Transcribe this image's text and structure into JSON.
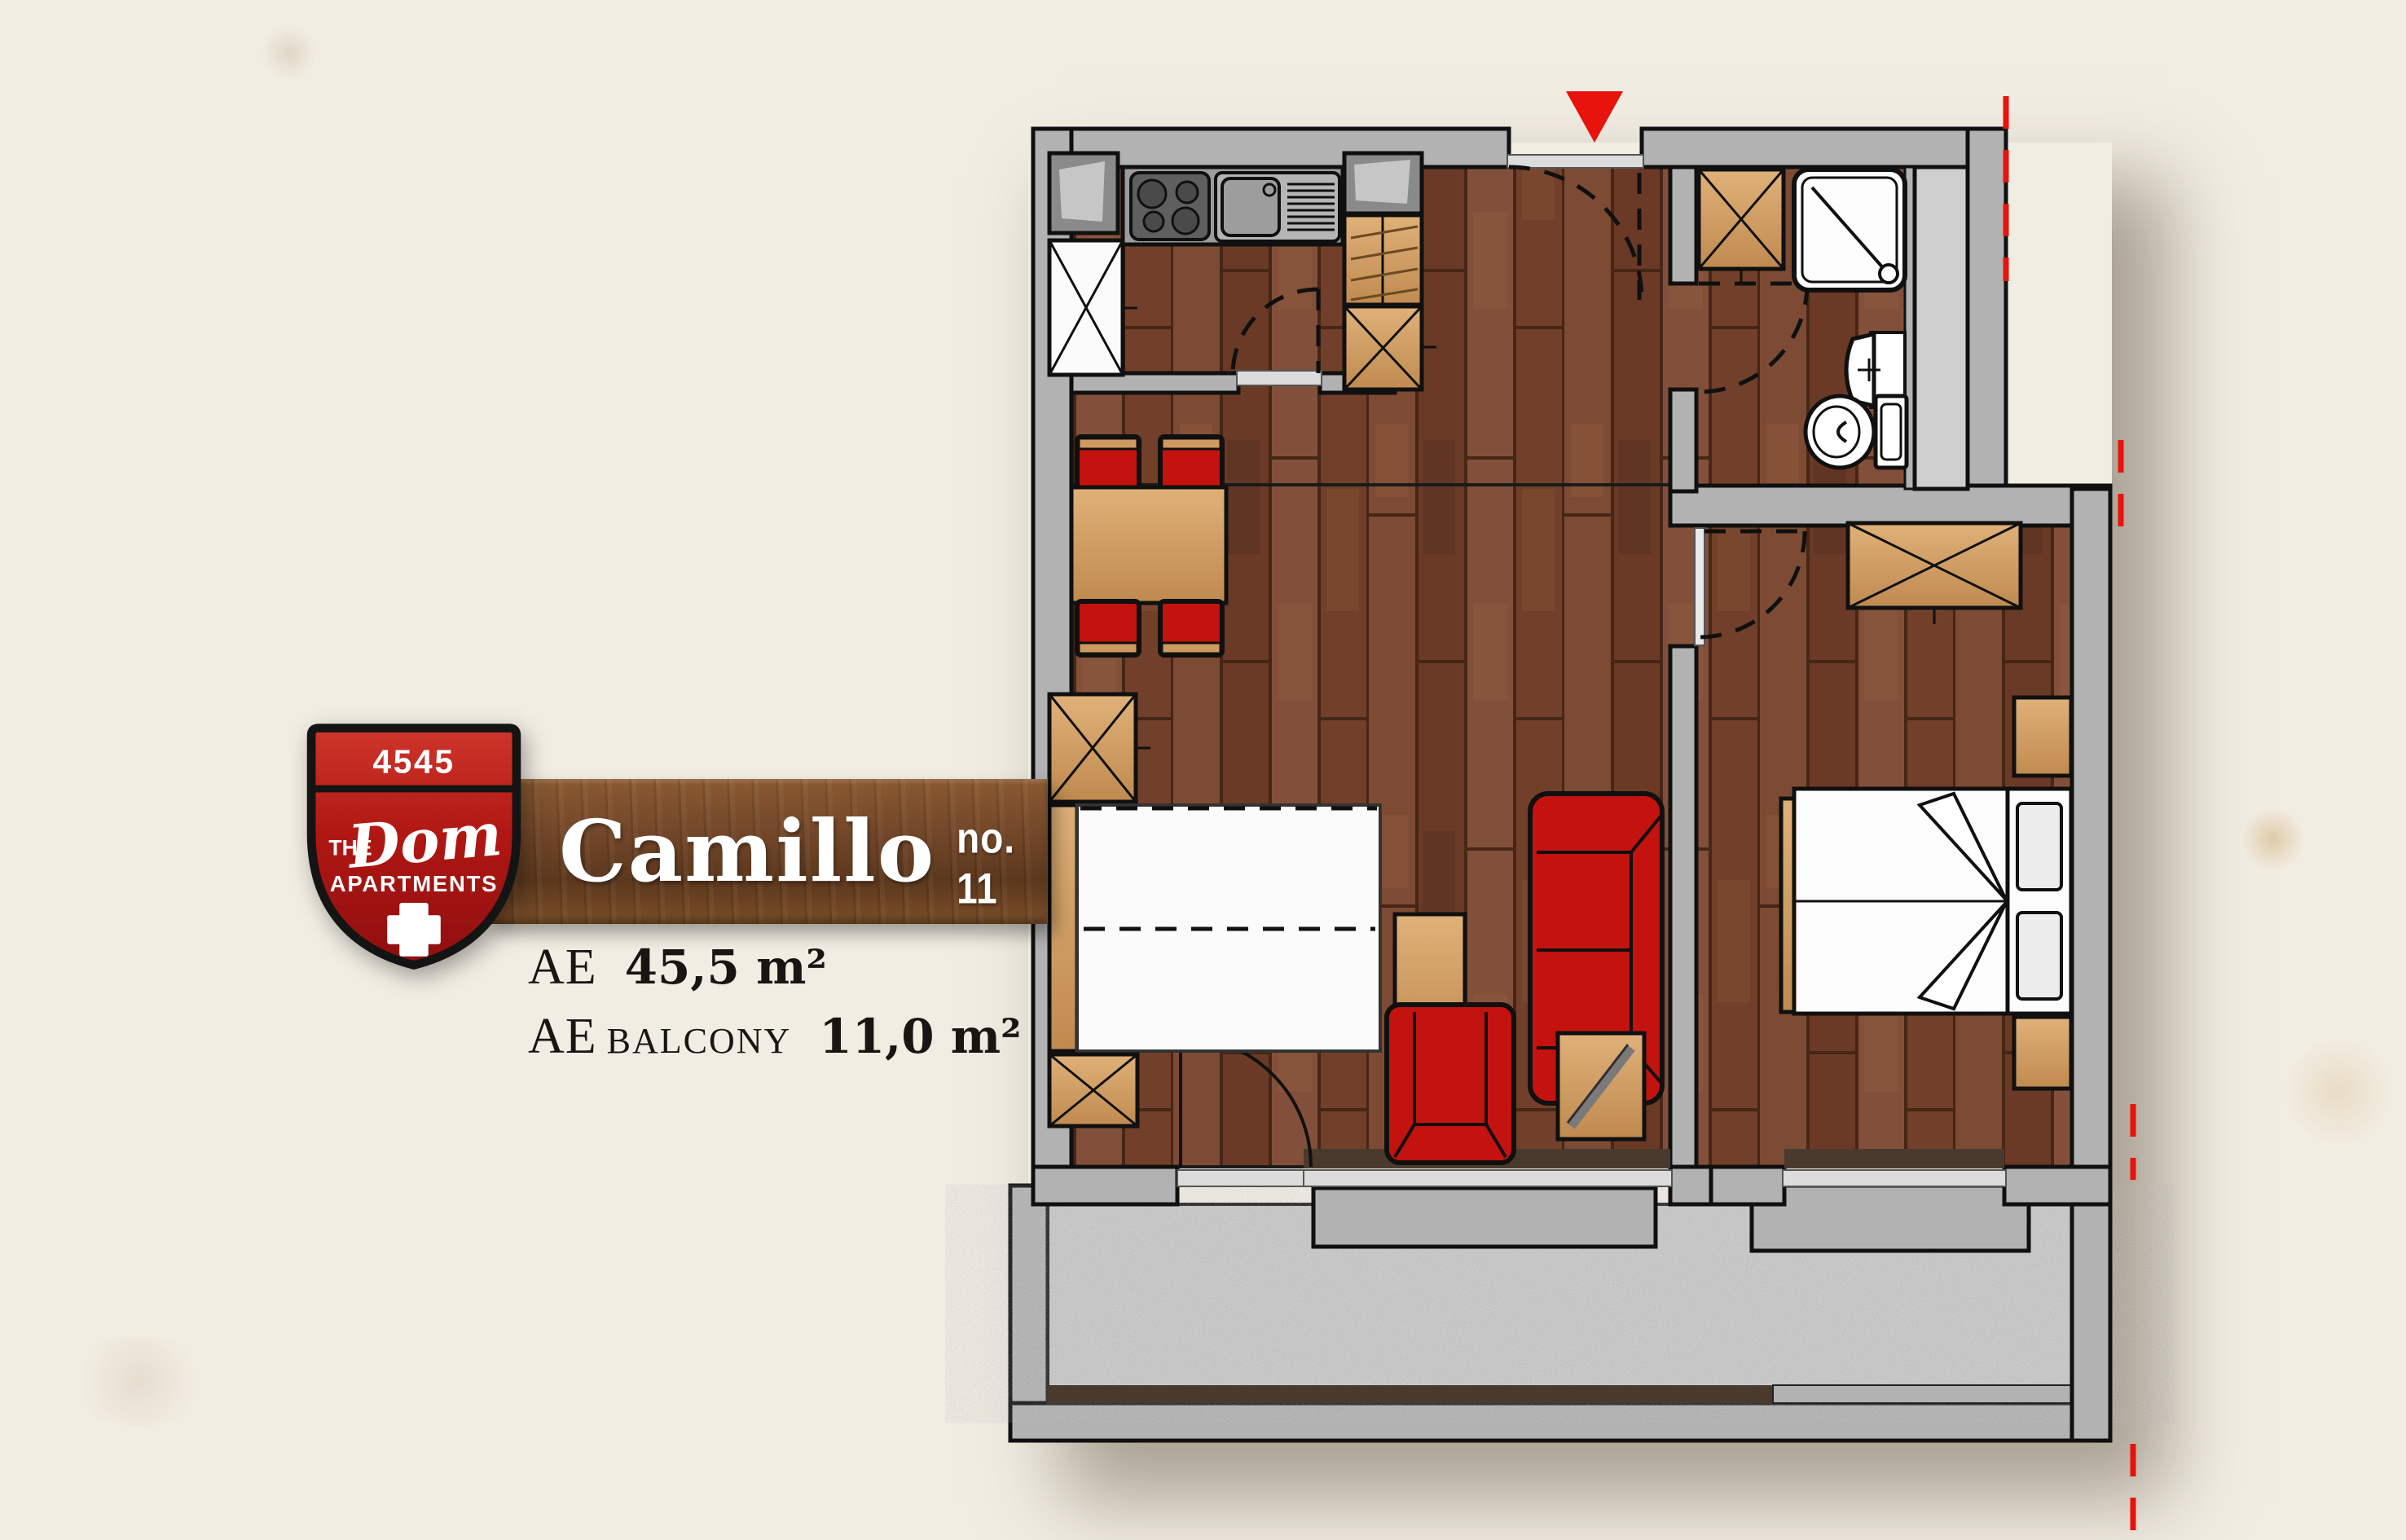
{
  "badge": {
    "number": "4545",
    "the": "THE",
    "name": "Dom",
    "apartments": "APARTMENTS"
  },
  "banner": {
    "apartment_name": "Camillo",
    "unit_number": "no. 11"
  },
  "areas": {
    "ae1": {
      "label": "AE",
      "value": "45,5 m²"
    },
    "ae2": {
      "label": "AE",
      "sublabel": "BALCONY",
      "value": "11,0 m²"
    }
  },
  "plan": {
    "entry_marker": "red-triangle-down",
    "section_markers": "red-dashed-lines",
    "colors": {
      "paper": "#f2ede3",
      "wall_gray": "#b2b2b2",
      "wood_floor": "#7a4630",
      "banner_wood": "#74482a",
      "furniture_tan": "#cf9a5f",
      "furniture_red": "#c4120e",
      "accent_red": "#e8130c",
      "balcony_concrete": "#c8c8c8",
      "badge_red": "#b01713"
    }
  }
}
